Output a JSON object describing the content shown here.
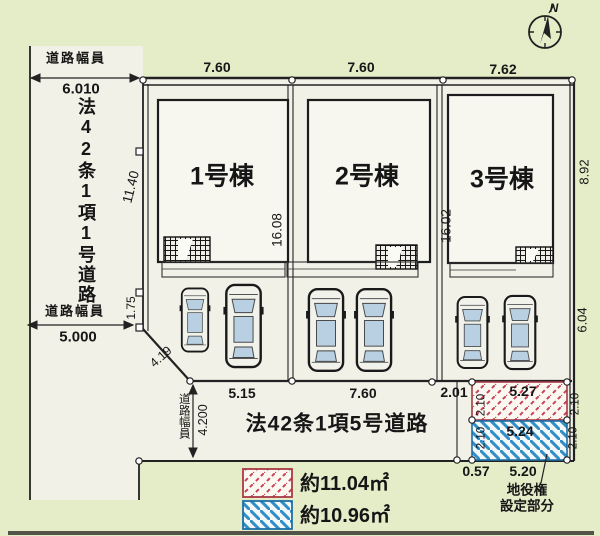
{
  "compass": {
    "north_label": "N"
  },
  "roads": {
    "left": {
      "width_caption_top": "道路幅員",
      "width_value_top": "6.010",
      "name_vertical": "法42条1項1号道路",
      "width_caption_bottom": "道路幅員",
      "width_value_bottom": "5.000"
    },
    "bottom": {
      "name": "法42条1項5号道路",
      "width_caption": "道路幅員",
      "width_value": "4.200"
    }
  },
  "buildings": [
    {
      "label": "1号棟",
      "frontage": "7.60",
      "depth": "16.08"
    },
    {
      "label": "2号棟",
      "frontage": "7.60",
      "depth": "16.02"
    },
    {
      "label": "3号棟",
      "frontage": "7.62"
    }
  ],
  "dimensions": {
    "west_boundary": "11.40",
    "west_step": "1.75",
    "corner_cut": "4.19",
    "east_upper": "8.92",
    "east_lower": "6.04",
    "parking_front_1": "5.15",
    "parking_front_2": "7.60",
    "parking_front_3": "2.01",
    "easement_bottom_left": "0.57",
    "easement_bottom_right": "5.20"
  },
  "easement": {
    "red_area": {
      "length": "5.27",
      "width_left": "2.10",
      "width_right": "2.10"
    },
    "blue_area": {
      "length": "5.24",
      "width_left": "2.10",
      "width_right": "2.10"
    },
    "note_line1": "地役権",
    "note_line2": "設定部分"
  },
  "legend": {
    "red_label": "約11.04㎡",
    "blue_label": "約10.96㎡"
  },
  "colors": {
    "background": "#e5ecc8",
    "ground": "#f2f1e8",
    "line": "#222222",
    "red_hatch": "#c84454",
    "blue_hatch": "#2f8fc6",
    "car_window": "#b9cfe2"
  }
}
